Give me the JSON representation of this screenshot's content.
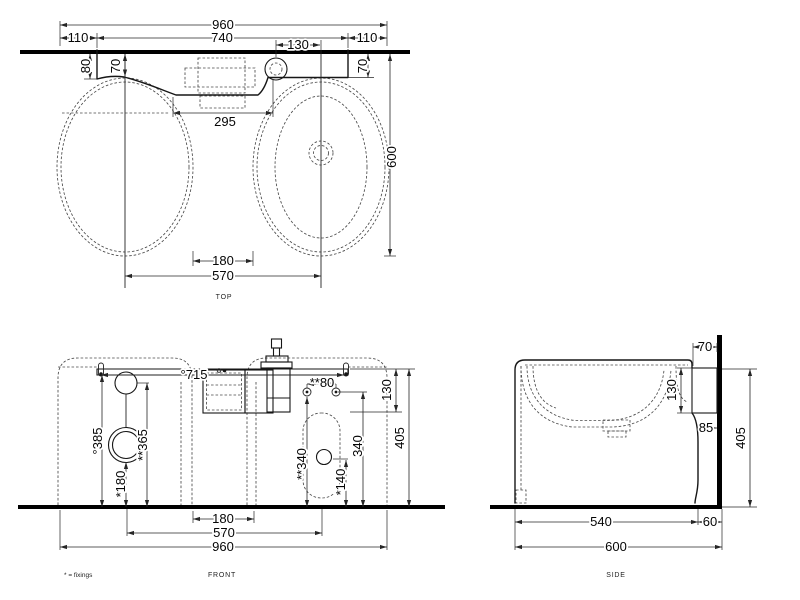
{
  "colors": {
    "ink": "#161616",
    "hidden_line": "#4b4b4b",
    "background": "#ffffff"
  },
  "footnote": "* = fixings",
  "views": {
    "top": {
      "label": "TOP",
      "dims": {
        "overall_width": "960",
        "offset_left": "110",
        "counter_width": "740",
        "tap_to_centre": "130",
        "offset_right": "110",
        "edge_depth_left": "80",
        "centre_depth_left": "70",
        "centre_depth_right": "70",
        "recess_width": "295",
        "overall_depth": "600",
        "bowl_gap": "180",
        "bowl_centres": "570"
      }
    },
    "front": {
      "label": "FRONT",
      "dims": {
        "fixing_span": "°715",
        "fixing_pair_span": "**80",
        "apron_height": "130",
        "waste_height_left": "°385",
        "overflow_height": "**365",
        "trap_height": "*180",
        "fixing_height_inner": "**340",
        "waste_height_right": "*140",
        "fixing_height": "340",
        "overall_height": "405",
        "bowl_gap": "180",
        "bowl_centres": "570",
        "overall_width": "960"
      }
    },
    "side": {
      "label": "SIDE",
      "dims": {
        "bracket_depth": "70",
        "bracket_height": "130",
        "back_clearance": "85",
        "overall_height": "405",
        "base_depth": "540",
        "wall_gap": "60",
        "overall_depth": "600"
      }
    }
  }
}
